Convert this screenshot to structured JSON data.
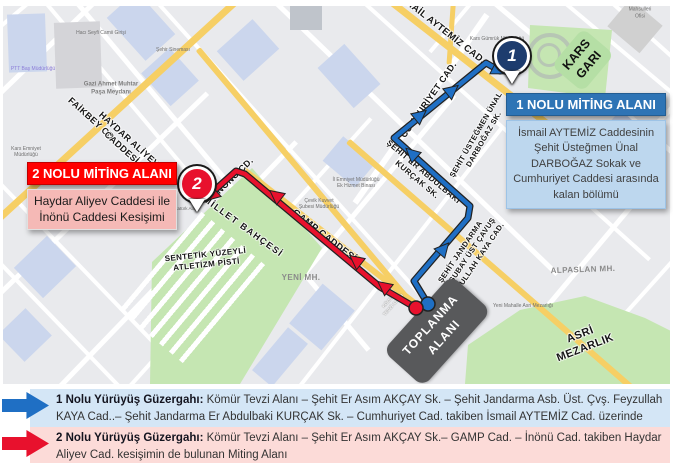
{
  "colors": {
    "route_blue": "#1f6fc4",
    "route_red": "#e8112d",
    "miting1_header_bg": "#2e74b5",
    "miting1_body_bg": "#bdd7ee",
    "miting2_header_bg": "#ff0000",
    "miting2_body_bg": "#f5b9b6",
    "legend_row1_bg": "#d4e6f6",
    "legend_row2_bg": "#fcdbd8",
    "road_yellow": "#f6cf65",
    "park_green": "#c5e6b2",
    "assembly_area_bg": "#58595b"
  },
  "markers": {
    "marker1": {
      "number": "1"
    },
    "marker2": {
      "number": "2"
    }
  },
  "boxes": {
    "miting1": {
      "title": "1 NOLU MİTİNG ALANI",
      "body": "İsmail AYTEMİZ Caddesinin Şehit Üsteğmen Ünal DARBOĞAZ Sokak ve Cumhuriyet Caddesi arasında kalan bölümü"
    },
    "miting2": {
      "title": "2 NOLU MİTİNG ALANI",
      "body": "Haydar Aliyev Caddesi ile İnönü Caddesi Kesişimi"
    }
  },
  "map_labels": {
    "ismail_aytemiz": "İSMAİL AYTEMİZ  CAD.",
    "cumhuriyet": "CUMHURİYET CAD.",
    "darbogaz": "ŞEHİT ÜSTEĞMEN ÜNAL\nDARBOĞAZ SK.",
    "kurcak": "ŞEHİT ER ABDULBAKİ\nKURÇAK SK.",
    "feyzullah": "ŞEHİT JANDARMA\nASTSUBAY ÜST ÇAVUŞ\nFEYZULLAH KAYA CAD.",
    "faikbey": "FAİKBEY CD.",
    "haydar_aliyev": "HAYDAR ALİYEV\nCADDESİ",
    "inonu": "İNÖNÜ CD.",
    "gamp": "GAMP CADDESİ",
    "millet_bahcesi": "MİLLET BAHÇESİ",
    "atletizm": "SENTETİK YÜZEYLİ\nATLETİZM PİSTİ",
    "asri_mezarlik": "ASRİ\nMEZARLIK",
    "alpaslan": "ALPASLAN MH.",
    "yeni_mh": "YENİ MH.",
    "kars_gari": "KARS\nGARI",
    "toplanma": "TOPLANMA\nALANI",
    "komur_tevzi": "KÖMÜR\nTEVZİ ALANI"
  },
  "pois": {
    "gazi_meydani": "Gazi Ahmet Muhtar\nPaşa Meydanı",
    "ptt": "PTT Baş Müdürlüğü",
    "kars_emniyet": "Kars Emniyet\nMüdürlüğü",
    "haci_seyfi": "Hacı Seyfi Camii Girişi",
    "sehir_sinemasi": "Şehir Sineması",
    "gumruk": "Kars Gümrük Müdürlüğü",
    "il_emniyet": "İl Emniyet Müdürlüğü\nEk Hizmet Binası",
    "cevik_kuvvet": "Çevik Kuvvet\nŞubesi Müdürlüğü",
    "yeni_mezarlik": "Yeni Mahalle Asri Mezarlığı",
    "toprak": "Toprak Mahsulleri Ofisi",
    "ataturk_alani": "Atatürk Alanı"
  },
  "legend": {
    "route1": {
      "label": "1 Nolu Yürüyüş Güzergahı:",
      "text": " Kömür Tevzi Alanı – Şehit Er Asım AKÇAY Sk. – Şehit Jandarma Asb. Üst. Çvş. Feyzullah KAYA Cad..– Şehit Jandarma Er Abdulbaki KURÇAK Sk. – Cumhuriyet Cad. takiben İsmail AYTEMİZ Cad. üzerinde bulunan Miting Alanı"
    },
    "route2": {
      "label": "2 Nolu Yürüyüş Güzergahı:",
      "text": " Kömür Tevzi Alanı – Şehit Er Asım AKÇAY Sk.– GAMP Cad. – İnönü Cad. takiben Haydar Aliyev Cad. kesişimin de bulunan Miting Alanı"
    }
  }
}
